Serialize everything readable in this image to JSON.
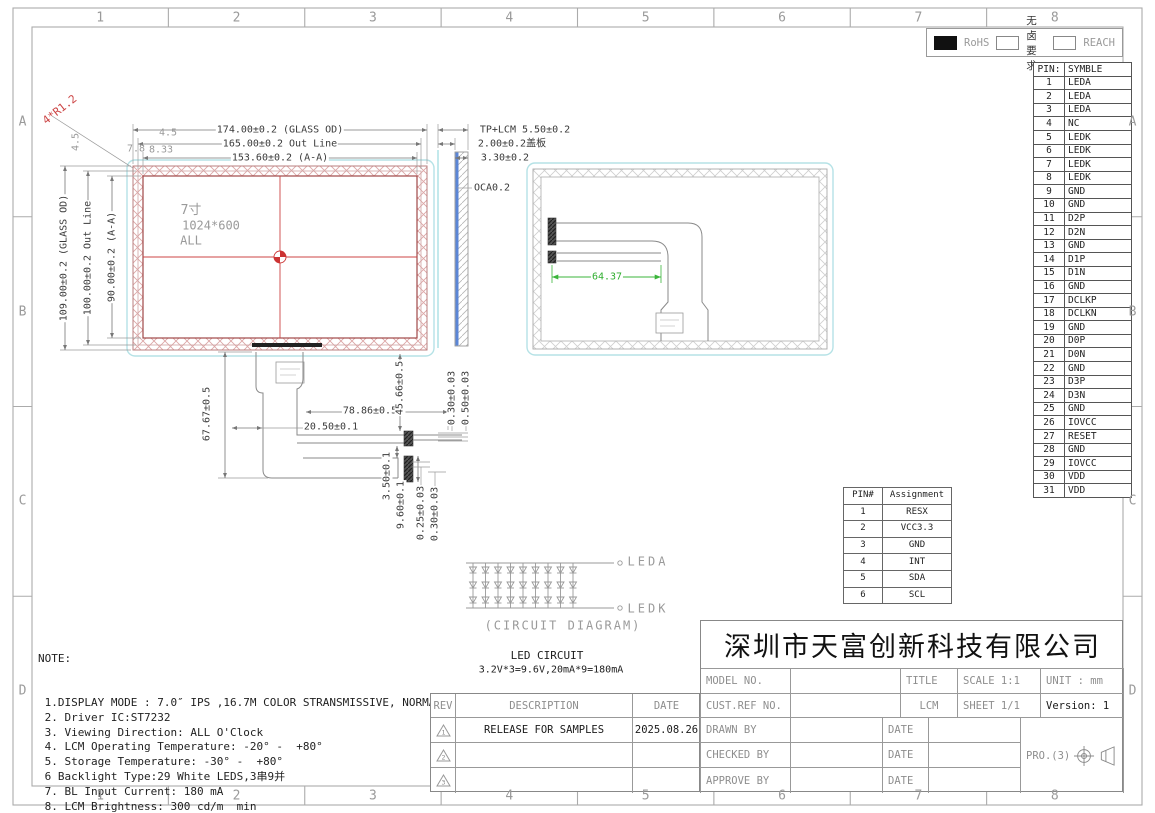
{
  "frame": {
    "columns": [
      "1",
      "2",
      "3",
      "4",
      "5",
      "6",
      "7",
      "8"
    ],
    "rows": [
      "A",
      "B",
      "C",
      "D"
    ]
  },
  "legend": {
    "rohs": "RoHS",
    "halogen_free": "无卤要求",
    "reach": "REACH"
  },
  "pin_table": {
    "title_pin": "PIN:",
    "title_symbol": "SYMBLE",
    "rows": [
      [
        "1",
        "LEDA"
      ],
      [
        "2",
        "LEDA"
      ],
      [
        "3",
        "LEDA"
      ],
      [
        "4",
        "NC"
      ],
      [
        "5",
        "LEDK"
      ],
      [
        "6",
        "LEDK"
      ],
      [
        "7",
        "LEDK"
      ],
      [
        "8",
        "LEDK"
      ],
      [
        "9",
        "GND"
      ],
      [
        "10",
        "GND"
      ],
      [
        "11",
        "D2P"
      ],
      [
        "12",
        "D2N"
      ],
      [
        "13",
        "GND"
      ],
      [
        "14",
        "D1P"
      ],
      [
        "15",
        "D1N"
      ],
      [
        "16",
        "GND"
      ],
      [
        "17",
        "DCLKP"
      ],
      [
        "18",
        "DCLKN"
      ],
      [
        "19",
        "GND"
      ],
      [
        "20",
        "D0P"
      ],
      [
        "21",
        "D0N"
      ],
      [
        "22",
        "GND"
      ],
      [
        "23",
        "D3P"
      ],
      [
        "24",
        "D3N"
      ],
      [
        "25",
        "GND"
      ],
      [
        "26",
        "IOVCC"
      ],
      [
        "27",
        "RESET"
      ],
      [
        "28",
        "GND"
      ],
      [
        "29",
        "IOVCC"
      ],
      [
        "30",
        "VDD"
      ],
      [
        "31",
        "VDD"
      ]
    ]
  },
  "assignment_table": {
    "title_pin": "PIN#",
    "title_assignment": "Assignment",
    "rows": [
      [
        "1",
        "RESX"
      ],
      [
        "2",
        "VCC3.3"
      ],
      [
        "3",
        "GND"
      ],
      [
        "4",
        "INT"
      ],
      [
        "5",
        "SDA"
      ],
      [
        "6",
        "SCL"
      ]
    ]
  },
  "front_view": {
    "size": "7寸",
    "resolution": "1024*600",
    "mode": "ALL"
  },
  "dims": {
    "glass_w": "174.00±0.2 (GLASS OD)",
    "outline_w": "165.00±0.2 Out Line",
    "aa_w": "153.60±0.2 (A-A)",
    "glass_h": "109.00±0.2 (GLASS OD)",
    "outline_h": "100.00±0.2 Out Line",
    "aa_h": "90.00±0.2 (A-A)",
    "corner_radius": "4*R1.2",
    "corner_a": "4.5",
    "corner_b": "7.8",
    "corner_c": "8.33",
    "corner_d": "4.5",
    "tp_lcm": "TP+LCM 5.50±0.2",
    "cover": "2.00±0.2盖板",
    "total_thk": "3.30±0.2",
    "oca": "OCA0.2",
    "fpc_len": "67.67±0.5",
    "fpc_w": "78.86±0.5",
    "fpc_off": "20.50±0.1",
    "conn_off": "45.66±0.5",
    "thk_a": "0.30±0.03",
    "thk_b": "0.50±0.03",
    "stiff_a": "3.50±0.1",
    "stiff_b": "9.60±0.1",
    "stiff_c": "0.25±0.03",
    "stiff_d": "0.30±0.03",
    "back_w": "64.37"
  },
  "led_circuit": {
    "columns": 9,
    "rows": 3,
    "anode_label": "LEDA",
    "cathode_label": "LEDK",
    "caption": "(CIRCUIT DIAGRAM)",
    "title": "LED CIRCUIT",
    "spec": "3.2V*3=9.6V,20mA*9=180mA"
  },
  "notes": {
    "heading": "NOTE:",
    "lines": [
      "1.DISPLAY MODE : 7.0″ IPS ,16.7M COLOR STRANSMISSIVE, NORMALLY BLACK",
      "2. Driver IC:ST7232",
      "3. Viewing Direction: ALL O'Clock",
      "4. LCM Operating Temperature: -20° -  +80°",
      "5. Storage Temperature: -30° -  +80°",
      "6 Backlight Type:29 White LEDS,3串9并",
      "7. BL Input Current: 180 mA",
      "8. LCM Brightness: 300 cd/m  min",
      "9. ESD test: Contact:±4KV,Air:±8KV"
    ]
  },
  "title_block": {
    "company": "深圳市天富创新科技有限公司",
    "model_no": "MODEL NO.",
    "cust_ref": "CUST.REF NO.",
    "title_label": "TITLE",
    "title_value": "LCM",
    "scale": "SCALE 1:1",
    "sheet": "SHEET 1/1",
    "unit": "UNIT : mm",
    "version": "Version: 1",
    "drawn_by": "DRAWN BY",
    "checked_by": "CHECKED BY",
    "approve_by": "APPROVE BY",
    "date_label": "DATE",
    "projection": "PRO.(3)"
  },
  "rev_table": {
    "headers": [
      "REV",
      "DESCRIPTION",
      "DATE"
    ],
    "rows": [
      {
        "mark": "1",
        "description": "RELEASE FOR SAMPLES",
        "date": "2025.08.26"
      },
      {
        "mark": "2",
        "description": "",
        "date": ""
      },
      {
        "mark": "3",
        "description": "",
        "date": ""
      }
    ]
  },
  "colors": {
    "accent_red": "#cc4444",
    "dim_green": "#3bb53b",
    "hatch_pink": "#d9a0a0",
    "cover_blue": "#5b86d6",
    "outline_cyan": "#b5e2e6",
    "cad_gray": "#8a8a8a"
  }
}
